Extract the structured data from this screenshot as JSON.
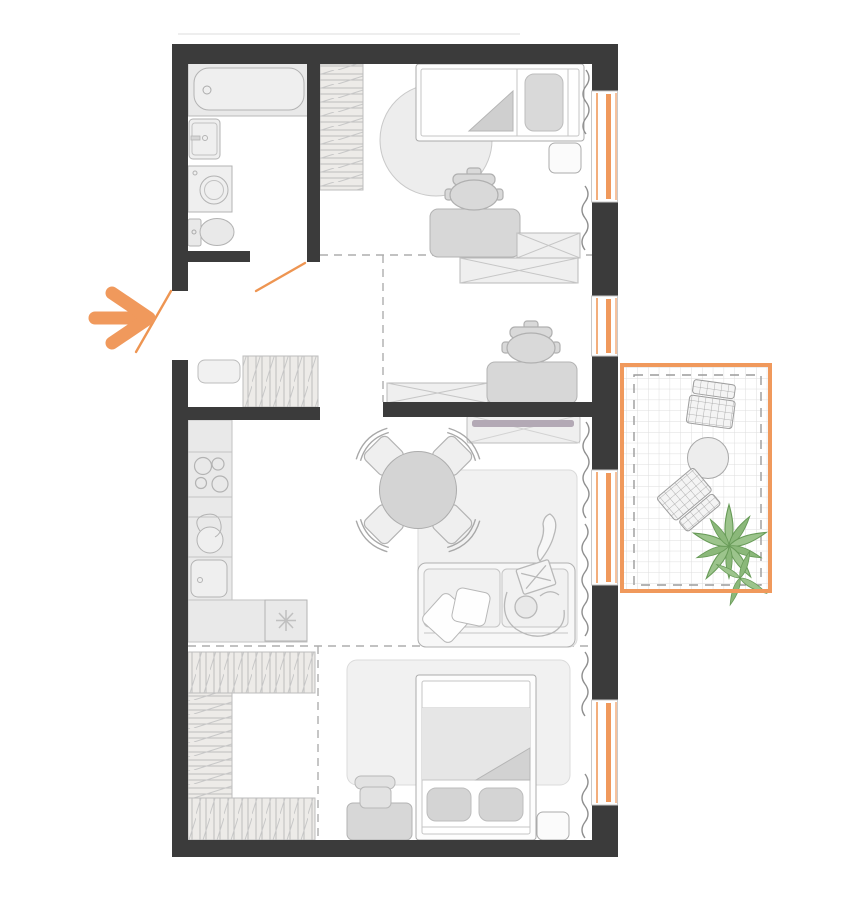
{
  "diagram": {
    "type": "apartment-floor-plan",
    "entrance_marker": "orange-arrow-pointing-right",
    "colors": {
      "wall": "#3B3B3B",
      "accent_orange": "#F0995C",
      "furniture_light": "#EBEBEB",
      "furniture_mid": "#D6D6D6",
      "outline": "#B3B3B3",
      "rug": "#F1F1F1",
      "tv_screen": "#B3A9B5",
      "plant_green": "#9CC48C",
      "balcony_grid": "#DEDEDE",
      "dashed_zone_line": "#ADADAD"
    },
    "rooms": [
      {
        "name": "bathroom",
        "position": "top-left",
        "furniture": [
          "bathtub",
          "washbasin",
          "washing-machine",
          "toilet"
        ]
      },
      {
        "name": "hallway",
        "position": "left-middle",
        "furniture": [
          "bench",
          "hatched-wardrobe"
        ],
        "features": [
          "entrance-door-swing",
          "bathroom-door-swing"
        ]
      },
      {
        "name": "bedroom-top",
        "position": "top-right",
        "furniture": [
          "hatched-wardrobe",
          "single-bed",
          "pillow",
          "round-rug",
          "nightstand",
          "desk",
          "office-chair",
          "storage-box",
          "storage-box"
        ]
      },
      {
        "name": "workspace-nook",
        "position": "center",
        "furniture": [
          "desk",
          "office-chair",
          "low-storage-box"
        ]
      },
      {
        "name": "kitchen",
        "position": "center-left",
        "furniture": [
          "counter-run",
          "cooktop-4-burners",
          "round-sink",
          "square-sink",
          "corner-counter",
          "refrigerator-with-snowflake"
        ]
      },
      {
        "name": "living-room",
        "position": "center-right",
        "furniture": [
          "tv-console",
          "tv",
          "round-dining-table",
          "dining-chair",
          "dining-chair",
          "dining-chair",
          "dining-chair",
          "rug",
          "sofa",
          "throw-pillow",
          "throw-pillow",
          "person-with-laptop"
        ]
      },
      {
        "name": "walk-in-closet",
        "position": "bottom-left",
        "furniture": [
          "hatched-wardrobe-top",
          "hatched-wardrobe-left",
          "hatched-wardrobe-bottom"
        ]
      },
      {
        "name": "bedroom-bottom",
        "position": "bottom-right",
        "furniture": [
          "rug",
          "double-bed",
          "pillow",
          "pillow",
          "blanket-fold",
          "nightstand",
          "desk",
          "chair"
        ]
      },
      {
        "name": "balcony",
        "position": "right",
        "floor": "tile-grid",
        "furniture": [
          "wicker-chair",
          "wicker-chair",
          "round-table",
          "potted-plant"
        ]
      }
    ],
    "windows": [
      {
        "wall": "right",
        "order": 1,
        "serves": "bedroom-top"
      },
      {
        "wall": "right",
        "order": 2,
        "serves": "workspace-nook"
      },
      {
        "wall": "right",
        "order": 3,
        "serves": "balcony-door"
      },
      {
        "wall": "right",
        "order": 4,
        "serves": "bedroom-bottom"
      }
    ],
    "doors": [
      {
        "name": "entrance-door",
        "symbol": "orange-swing-line"
      },
      {
        "name": "bathroom-door",
        "symbol": "orange-swing-line"
      }
    ],
    "curtains": 6
  }
}
